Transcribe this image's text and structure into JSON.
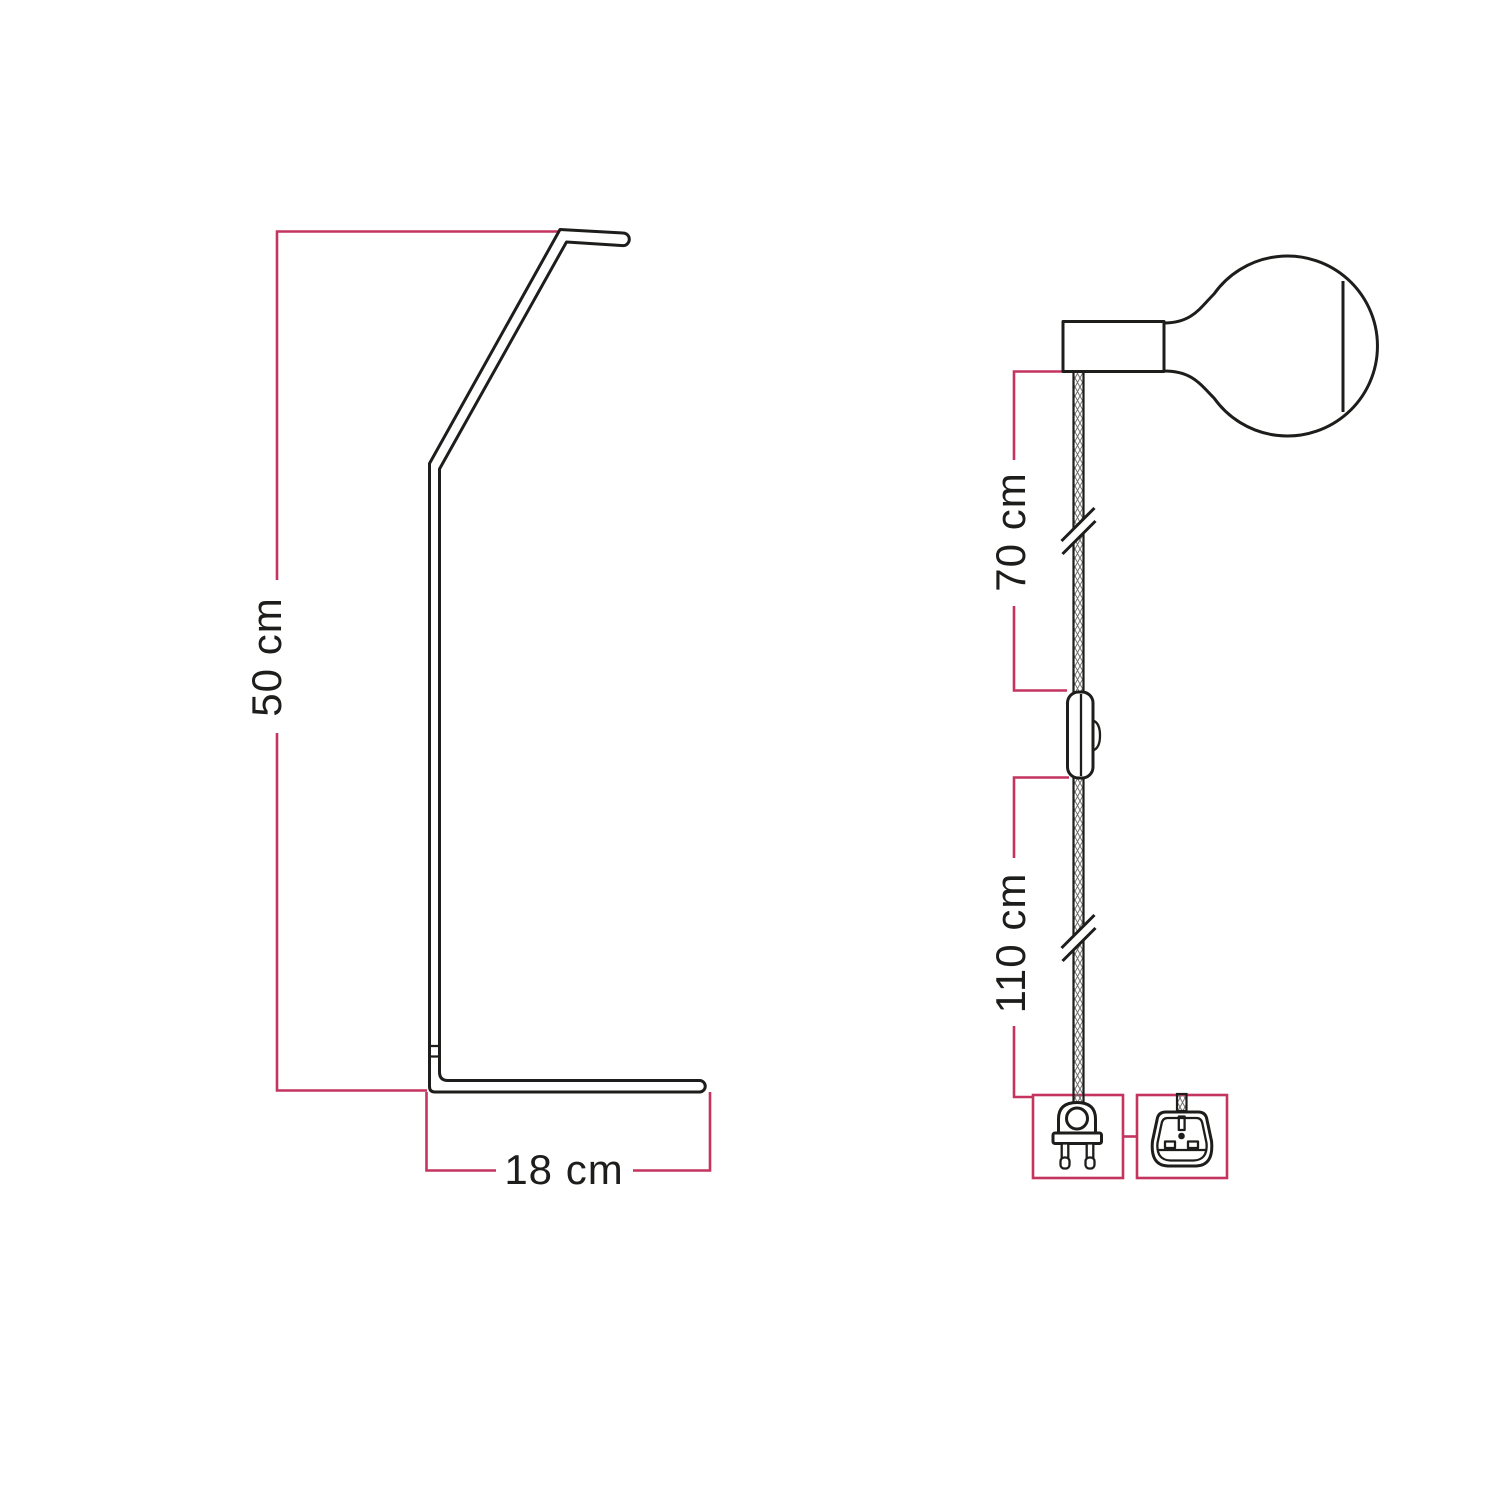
{
  "page": {
    "background": "#ffffff",
    "line_color": "#1d1d1b",
    "accent_color": "#c4345f",
    "cable_hatch_color": "#6f6f6f"
  },
  "left_figure": {
    "description": "lamp stand side view",
    "height_dimension": "50 cm",
    "base_dimension": "18 cm"
  },
  "right_figure": {
    "description": "cable assembly with bulb, switch and plug",
    "upper_cable_dimension": "70 cm",
    "lower_cable_dimension": "110 cm"
  }
}
